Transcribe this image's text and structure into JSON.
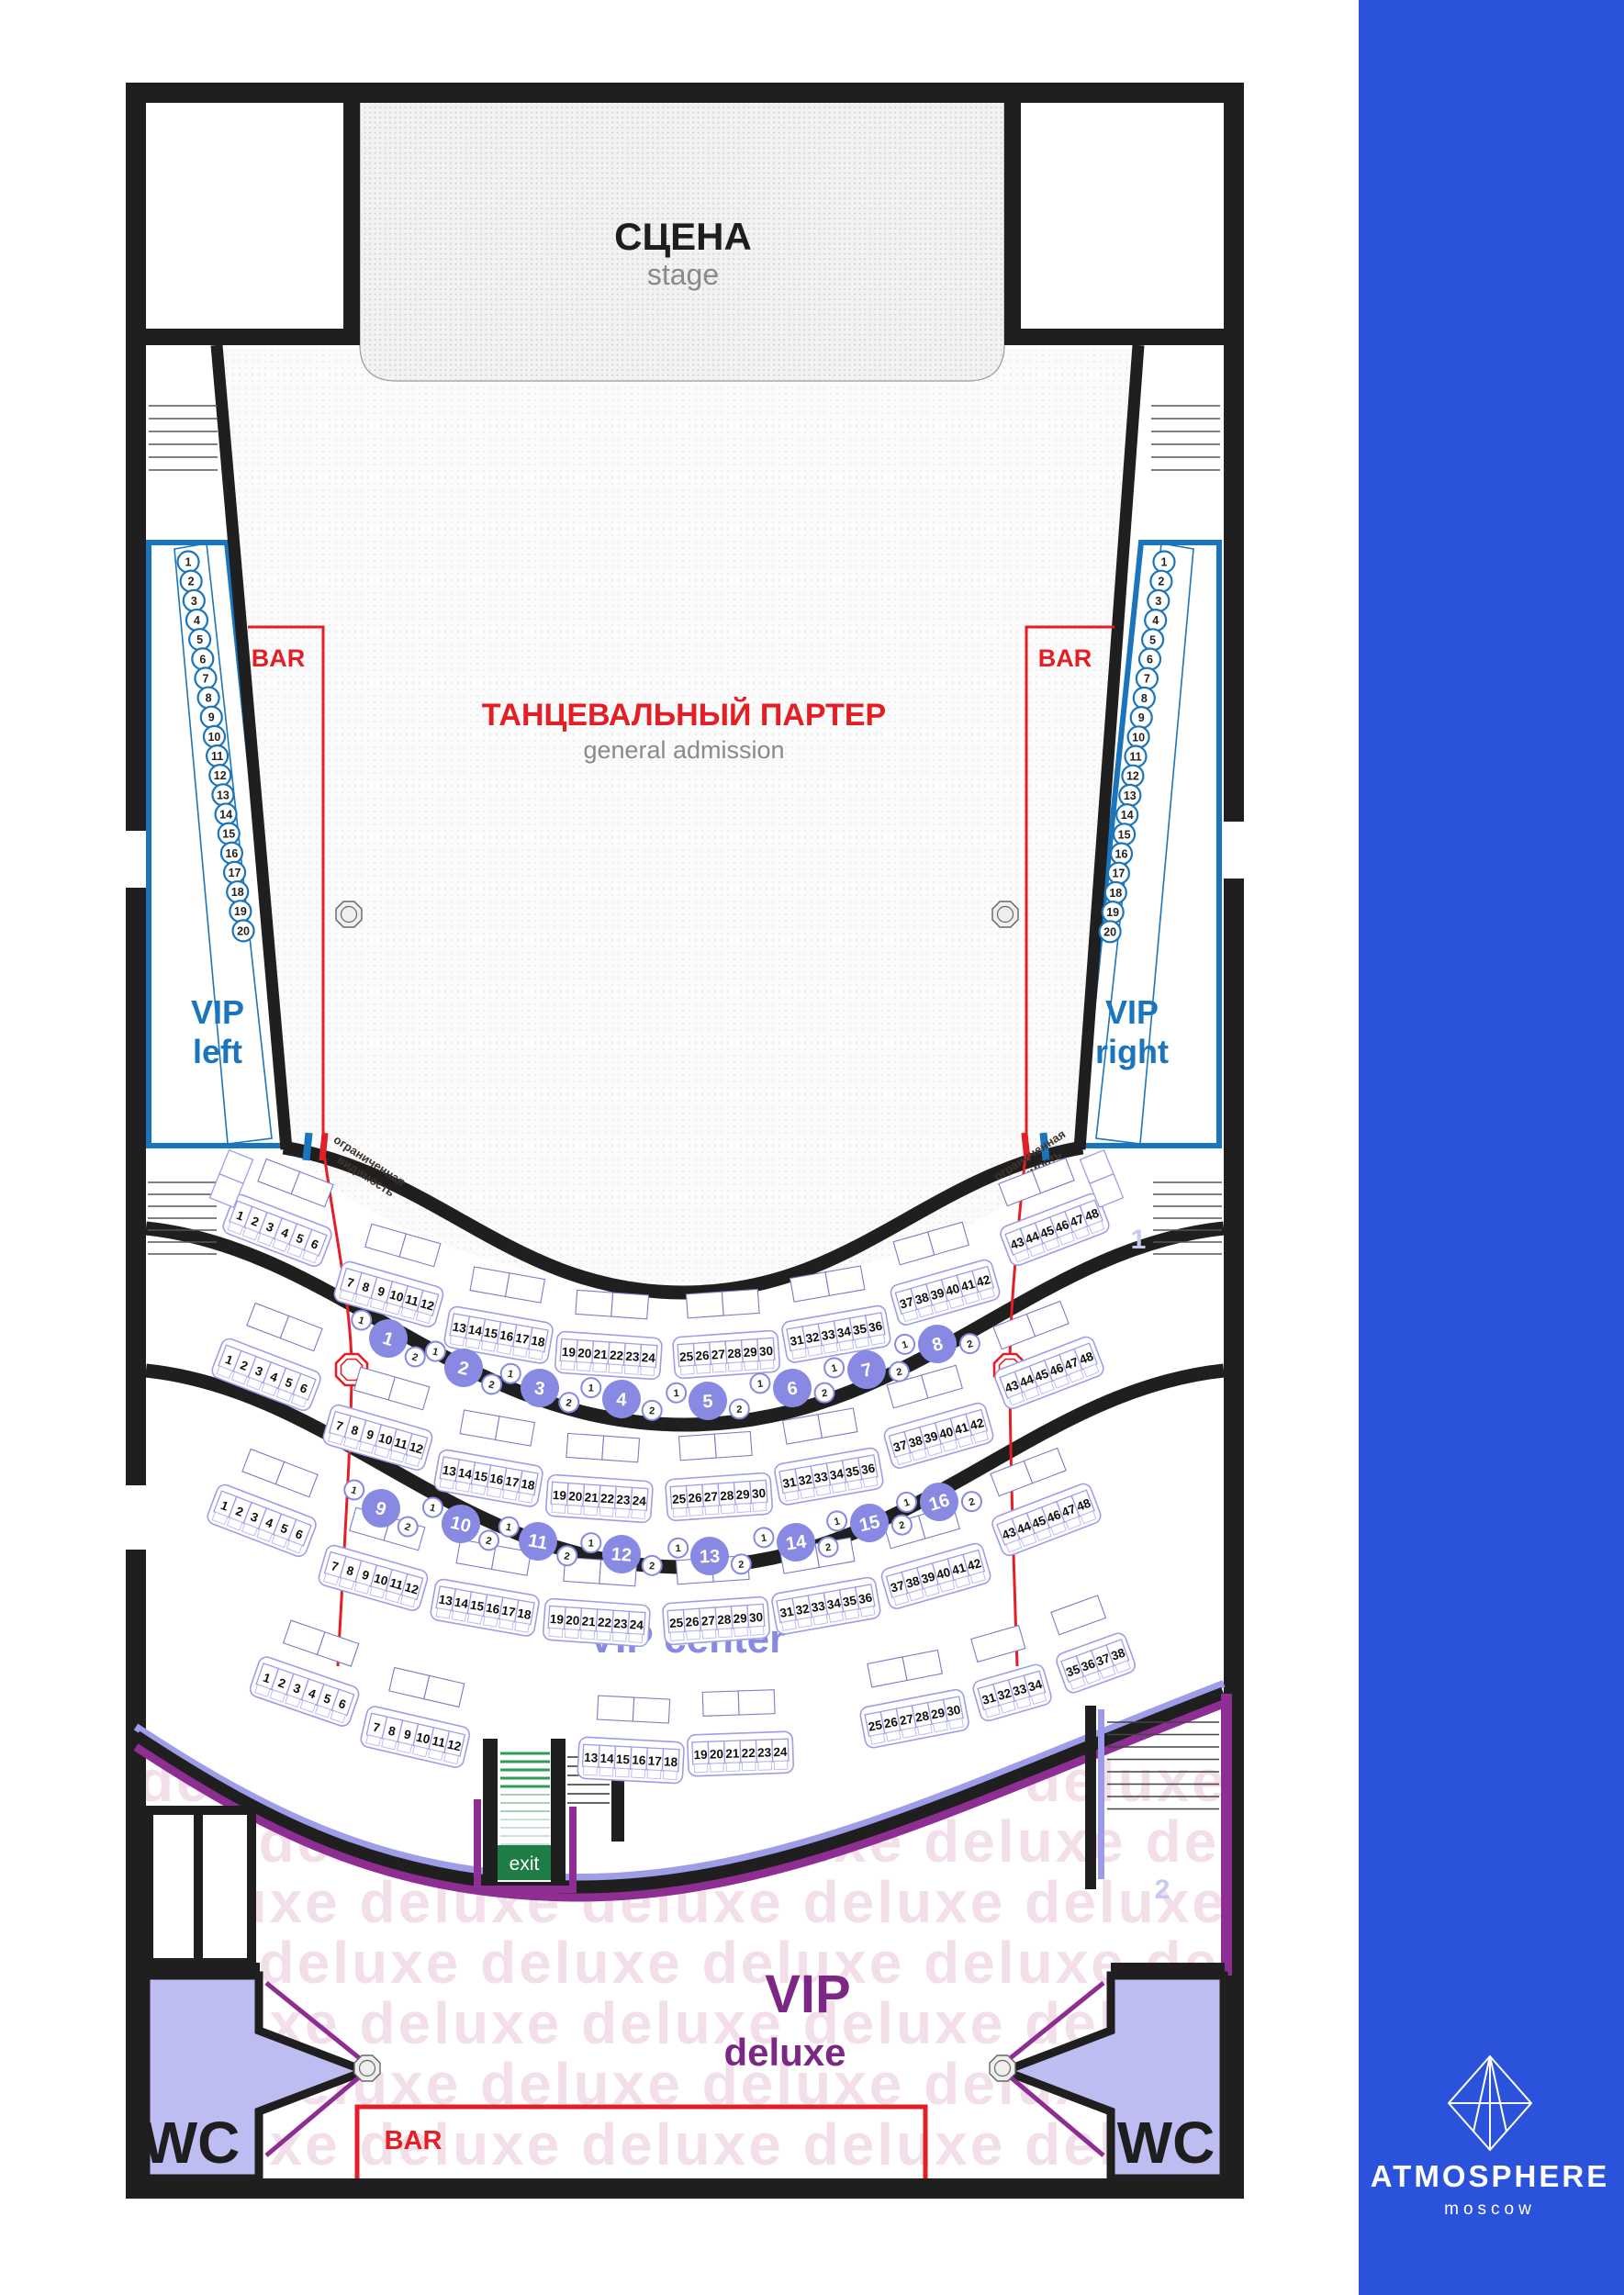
{
  "brand": {
    "name": "ATMOSPHERE",
    "city": "moscow"
  },
  "stage": {
    "title": "СЦЕНА",
    "subtitle": "stage"
  },
  "general_admission": {
    "title": "ТАНЦЕВАЛЬНЫЙ ПАРТЕР",
    "subtitle": "general admission"
  },
  "labels": {
    "bar": "BAR",
    "wc": "WC",
    "exit": "exit",
    "limited_visibility_line1": "ограниченная",
    "limited_visibility_line2": "видимость"
  },
  "zones": {
    "vip_left": {
      "line1": "VIP",
      "line2": "left"
    },
    "vip_right": {
      "line1": "VIP",
      "line2": "right"
    },
    "vip_center": "VIP center",
    "vip_deluxe": {
      "line1": "VIP",
      "line2": "deluxe"
    },
    "deluxe_watermark": "deluxe"
  },
  "side_seats": {
    "left": [
      "1",
      "2",
      "3",
      "4",
      "5",
      "6",
      "7",
      "8",
      "9",
      "10",
      "11",
      "12",
      "13",
      "14",
      "15",
      "16",
      "17",
      "18",
      "19",
      "20"
    ],
    "right": [
      "1",
      "2",
      "3",
      "4",
      "5",
      "6",
      "7",
      "8",
      "9",
      "10",
      "11",
      "12",
      "13",
      "14",
      "15",
      "16",
      "17",
      "18",
      "19",
      "20"
    ]
  },
  "vip_center": {
    "rows": [
      {
        "blocks": [
          [
            "1",
            "2",
            "3",
            "4",
            "5",
            "6"
          ],
          [
            "7",
            "8",
            "9",
            "10",
            "11",
            "12"
          ],
          [
            "13",
            "14",
            "15",
            "16",
            "17",
            "18"
          ],
          [
            "19",
            "20",
            "21",
            "22",
            "23",
            "24"
          ],
          [
            "25",
            "26",
            "27",
            "28",
            "29",
            "30"
          ],
          [
            "31",
            "32",
            "33",
            "34",
            "35",
            "36"
          ],
          [
            "37",
            "38",
            "39",
            "40",
            "41",
            "42"
          ],
          [
            "43",
            "44",
            "45",
            "46",
            "47",
            "48"
          ]
        ]
      },
      {
        "blocks": [
          [
            "1",
            "2",
            "3",
            "4",
            "5",
            "6"
          ],
          [
            "7",
            "8",
            "9",
            "10",
            "11",
            "12"
          ],
          [
            "13",
            "14",
            "15",
            "16",
            "17",
            "18"
          ],
          [
            "19",
            "20",
            "21",
            "22",
            "23",
            "24"
          ],
          [
            "25",
            "26",
            "27",
            "28",
            "29",
            "30"
          ],
          [
            "31",
            "32",
            "33",
            "34",
            "35",
            "36"
          ],
          [
            "37",
            "38",
            "39",
            "40",
            "41",
            "42"
          ],
          [
            "43",
            "44",
            "45",
            "46",
            "47",
            "48"
          ]
        ]
      },
      {
        "blocks": [
          [
            "1",
            "2",
            "3",
            "4",
            "5",
            "6"
          ],
          [
            "7",
            "8",
            "9",
            "10",
            "11",
            "12"
          ],
          [
            "13",
            "14",
            "15",
            "16",
            "17",
            "18"
          ],
          [
            "19",
            "20",
            "21",
            "22",
            "23",
            "24"
          ],
          [
            "25",
            "26",
            "27",
            "28",
            "29",
            "30"
          ],
          [
            "31",
            "32",
            "33",
            "34",
            "35",
            "36"
          ],
          [
            "37",
            "38",
            "39",
            "40",
            "41",
            "42"
          ],
          [
            "43",
            "44",
            "45",
            "46",
            "47",
            "48"
          ]
        ]
      },
      {
        "blocks": [
          [
            "1",
            "2",
            "3",
            "4",
            "5",
            "6"
          ],
          [
            "7",
            "8",
            "9",
            "10",
            "11",
            "12"
          ],
          [
            "13",
            "14",
            "15",
            "16",
            "17",
            "18"
          ],
          [
            "19",
            "20",
            "21",
            "22",
            "23",
            "24"
          ],
          [
            "25",
            "26",
            "27",
            "28",
            "29",
            "30"
          ],
          [
            "31",
            "32",
            "33",
            "34"
          ],
          [
            "35",
            "36",
            "37",
            "38"
          ]
        ]
      }
    ],
    "front_tables": [
      "1",
      "2",
      "3",
      "4",
      "5",
      "6",
      "7",
      "8"
    ],
    "back_tables": [
      "9",
      "10",
      "11",
      "12",
      "13",
      "14",
      "15",
      "16"
    ],
    "table_seat_markers": [
      "1",
      "2"
    ]
  },
  "stair_levels": [
    "1",
    "2"
  ],
  "colors": {
    "wall": "#1F1F1F",
    "vip_blue": "#1B75BC",
    "red": "#E31E24",
    "periwinkle": "#8789E2",
    "periwinkle_light": "#9D9DE8",
    "periwinkle_pale": "#C9C9F0",
    "purple": "#8E2D92",
    "deluxe_label": "#7B2884",
    "watermark_pink": "#F3DFEA",
    "wc_fill": "#BDBDF2",
    "exit_green": "#1E7C45",
    "stair_green": "#2E9E57",
    "sidebar_blue": "#2B52DB",
    "gray_text": "#8A8A8A"
  }
}
